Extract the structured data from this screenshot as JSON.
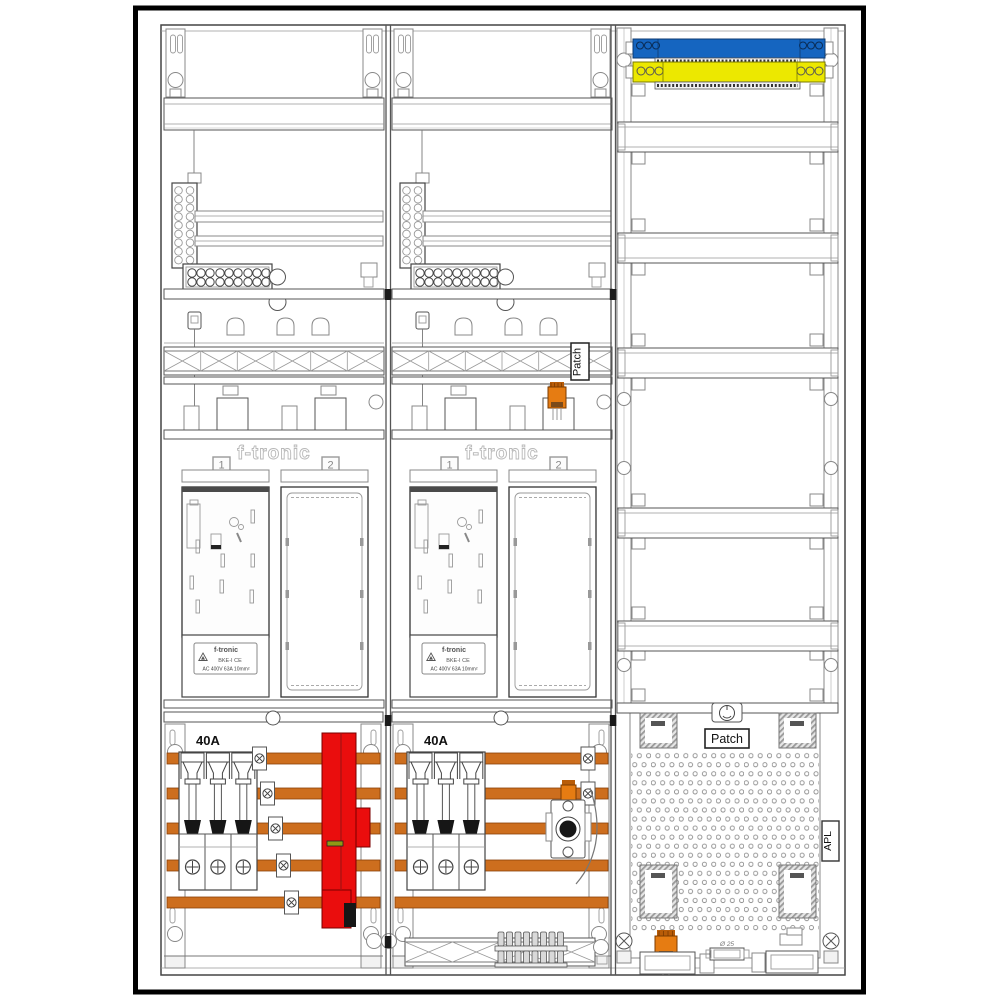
{
  "labels": {
    "patch": "Patch",
    "apl": "APL",
    "fuse_rating": "40A",
    "brand": "f-tronic",
    "field_1": "1",
    "field_2": "2",
    "plate_line1": "f-tronic",
    "plate_line2": "BKE-I  CE",
    "plate_line3": "AC 400V   63A   10mm²",
    "knockout_diameter": "Ø 25"
  },
  "colors": {
    "neutral_rail_blue": "#1565c0",
    "pe_rail_yellow": "#ece800",
    "busbar_copper": "#cd6e1e",
    "sls_switch_red": "#ea0d0d",
    "connector_orange": "#e67c12"
  }
}
